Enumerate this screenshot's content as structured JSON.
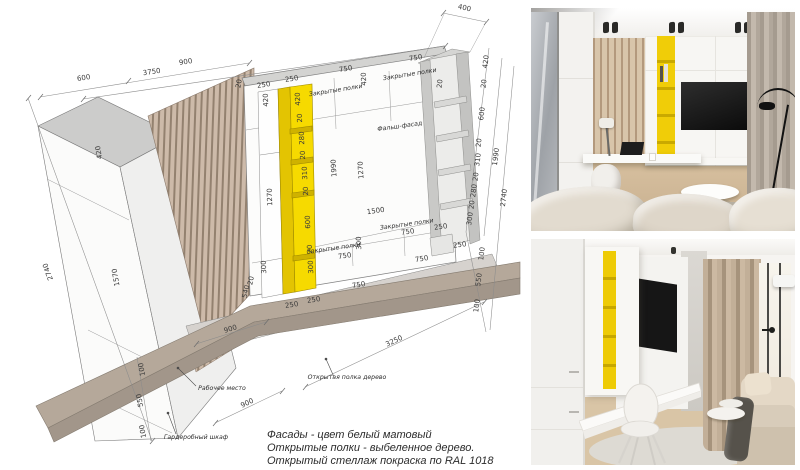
{
  "drawing": {
    "notes": [
      "Фасады - цвет белый матовый",
      "Открытые полки - выбеленное дерево.",
      "Открытый стеллаж покраска по RAL 1018"
    ],
    "palette": {
      "accent_yellow": "#f4d800",
      "wood_slat": "#c9b6a6",
      "shelf_wood": "#b3a79a",
      "line": "#7a7a7a"
    },
    "annotations": [
      {
        "t": "3750",
        "x": 152,
        "y": 74,
        "r": -8
      },
      {
        "t": "400",
        "x": 464,
        "y": 10,
        "r": 12
      },
      {
        "t": "600",
        "x": 84,
        "y": 80,
        "r": -9
      },
      {
        "t": "900",
        "x": 186,
        "y": 64,
        "r": -9
      },
      {
        "t": "20",
        "x": 241,
        "y": 84,
        "r": -80,
        "s": 5
      },
      {
        "t": "250",
        "x": 264,
        "y": 87,
        "r": -9,
        "s": 6.5
      },
      {
        "t": "250",
        "x": 292,
        "y": 81,
        "r": -9,
        "s": 6.5
      },
      {
        "t": "420",
        "x": 268,
        "y": 100,
        "r": -92,
        "s": 6.5
      },
      {
        "t": "1270",
        "x": 272,
        "y": 197,
        "r": -92,
        "s": 6.5
      },
      {
        "t": "300",
        "x": 266,
        "y": 267,
        "r": -92,
        "s": 6
      },
      {
        "t": "420",
        "x": 300,
        "y": 99,
        "r": -92,
        "s": 6.5
      },
      {
        "t": "20",
        "x": 302,
        "y": 118,
        "r": -92,
        "s": 4.5
      },
      {
        "t": "280",
        "x": 304,
        "y": 138,
        "r": -92,
        "s": 6
      },
      {
        "t": "20",
        "x": 305,
        "y": 155,
        "r": -92,
        "s": 4.5
      },
      {
        "t": "310",
        "x": 307,
        "y": 173,
        "r": -92,
        "s": 6
      },
      {
        "t": "20",
        "x": 308,
        "y": 191,
        "r": -92,
        "s": 4.5
      },
      {
        "t": "600",
        "x": 310,
        "y": 222,
        "r": -92,
        "s": 6
      },
      {
        "t": "20",
        "x": 312,
        "y": 249,
        "r": -92,
        "s": 4.5
      },
      {
        "t": "300",
        "x": 313,
        "y": 267,
        "r": -92,
        "s": 6
      },
      {
        "t": "750",
        "x": 346,
        "y": 71,
        "r": -9
      },
      {
        "t": "Закрытые полки",
        "x": 336,
        "y": 92,
        "r": -9,
        "cls": "label"
      },
      {
        "t": "420",
        "x": 366,
        "y": 79,
        "r": -92,
        "s": 6.5
      },
      {
        "t": "750",
        "x": 416,
        "y": 60,
        "r": -9
      },
      {
        "t": "Закрытые полки",
        "x": 410,
        "y": 76,
        "r": -9,
        "cls": "label"
      },
      {
        "t": "Фальш-фасад",
        "x": 400,
        "y": 128,
        "r": -8,
        "cls": "label"
      },
      {
        "t": "1990",
        "x": 336,
        "y": 168,
        "r": -93,
        "s": 6.5
      },
      {
        "t": "1270",
        "x": 363,
        "y": 170,
        "r": -93,
        "s": 6.5
      },
      {
        "t": "1500",
        "x": 376,
        "y": 213,
        "r": -8
      },
      {
        "t": "Закрытые полки",
        "x": 407,
        "y": 226,
        "r": -8,
        "cls": "label"
      },
      {
        "t": "750",
        "x": 408,
        "y": 234,
        "r": -8,
        "s": 6.5
      },
      {
        "t": "300",
        "x": 361,
        "y": 243,
        "r": -92,
        "s": 6
      },
      {
        "t": "Закрытые полки",
        "x": 334,
        "y": 250,
        "r": -8,
        "cls": "label"
      },
      {
        "t": "750",
        "x": 345,
        "y": 258,
        "r": -8,
        "s": 6.5
      },
      {
        "t": "250",
        "x": 441,
        "y": 229,
        "r": -8,
        "s": 6.5
      },
      {
        "t": "20",
        "x": 442,
        "y": 84,
        "r": -83,
        "s": 4.5
      },
      {
        "t": "420",
        "x": 488,
        "y": 62,
        "r": -83,
        "s": 6.5
      },
      {
        "t": "20",
        "x": 486,
        "y": 84,
        "r": -83,
        "s": 4.5
      },
      {
        "t": "600",
        "x": 484,
        "y": 114,
        "r": -83,
        "s": 6.5
      },
      {
        "t": "20",
        "x": 481,
        "y": 143,
        "r": -83,
        "s": 4.5
      },
      {
        "t": "310",
        "x": 480,
        "y": 160,
        "r": -83,
        "s": 6.5
      },
      {
        "t": "20",
        "x": 478,
        "y": 177,
        "r": -83,
        "s": 4.5
      },
      {
        "t": "280",
        "x": 476,
        "y": 191,
        "r": -83,
        "s": 6.5
      },
      {
        "t": "20",
        "x": 474,
        "y": 205,
        "r": -83,
        "s": 4.5
      },
      {
        "t": "300",
        "x": 472,
        "y": 219,
        "r": -83,
        "s": 6.5
      },
      {
        "t": "1990",
        "x": 498,
        "y": 157,
        "r": -83,
        "s": 6.5
      },
      {
        "t": "2740",
        "x": 506,
        "y": 198,
        "r": -83,
        "s": 6.5
      },
      {
        "t": "250",
        "x": 460,
        "y": 247,
        "r": -8,
        "s": 6.5
      },
      {
        "t": "100",
        "x": 484,
        "y": 254,
        "r": -83,
        "s": 6
      },
      {
        "t": "550",
        "x": 481,
        "y": 280,
        "r": -83,
        "s": 6.5
      },
      {
        "t": "100",
        "x": 479,
        "y": 306,
        "r": -83,
        "s": 6
      },
      {
        "t": "2740",
        "x": 50,
        "y": 271,
        "r": -110,
        "s": 7
      },
      {
        "t": "420",
        "x": 101,
        "y": 152,
        "r": -100,
        "s": 6.5
      },
      {
        "t": "1570",
        "x": 118,
        "y": 277,
        "r": -100,
        "s": 6.5
      },
      {
        "t": "100",
        "x": 144,
        "y": 369,
        "r": -100,
        "s": 6
      },
      {
        "t": "550",
        "x": 142,
        "y": 400,
        "r": -100,
        "s": 6.5
      },
      {
        "t": "100",
        "x": 145,
        "y": 431,
        "r": -100,
        "s": 6
      },
      {
        "t": "540",
        "x": 248,
        "y": 292,
        "r": -78,
        "s": 5.5
      },
      {
        "t": "20",
        "x": 253,
        "y": 281,
        "r": -78,
        "s": 4.5
      },
      {
        "t": "250",
        "x": 292,
        "y": 307,
        "r": -9,
        "s": 6.5
      },
      {
        "t": "250",
        "x": 314,
        "y": 302,
        "r": -9,
        "s": 6.5
      },
      {
        "t": "750",
        "x": 359,
        "y": 287,
        "r": -9
      },
      {
        "t": "750",
        "x": 422,
        "y": 261,
        "r": -9
      },
      {
        "t": "900",
        "x": 231,
        "y": 331,
        "r": -17
      },
      {
        "t": "900",
        "x": 248,
        "y": 405,
        "r": -25
      },
      {
        "t": "3250",
        "x": 395,
        "y": 343,
        "r": -25
      },
      {
        "t": "Рабочее место",
        "x": 222,
        "y": 390,
        "cls": "label"
      },
      {
        "t": "Гардеробный шкаф",
        "x": 196,
        "y": 439,
        "cls": "label"
      },
      {
        "t": "Открытая полка дерево",
        "x": 347,
        "y": 379,
        "cls": "label"
      }
    ]
  }
}
